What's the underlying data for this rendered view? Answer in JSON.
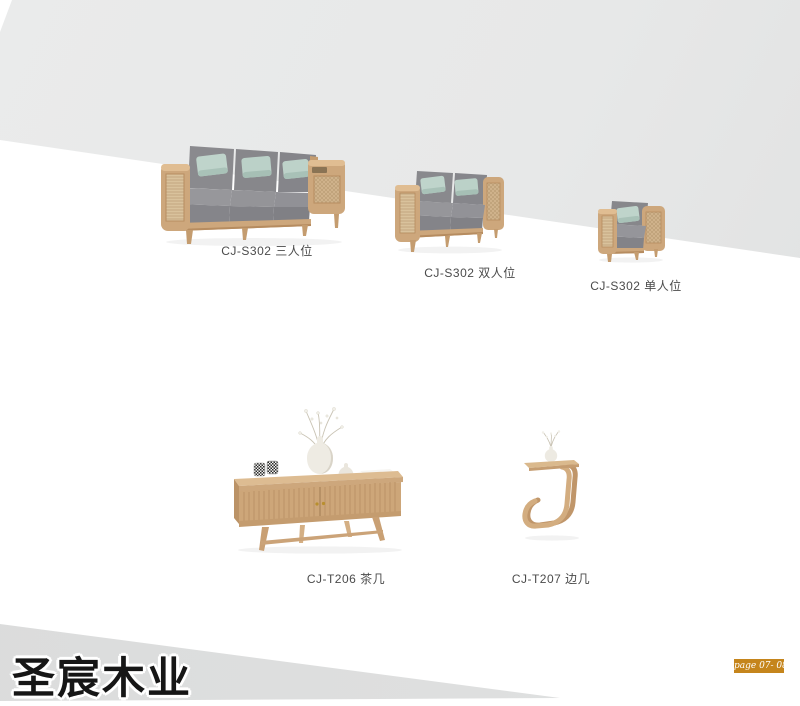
{
  "brand": {
    "name": "圣宸木业"
  },
  "page_badge": {
    "text": "page 07- 08",
    "bg_color": "#c5851c"
  },
  "products": [
    {
      "label": "CJ-S302 三人位",
      "kind": "three-seat-sofa"
    },
    {
      "label": "CJ-S302 双人位",
      "kind": "two-seat-sofa"
    },
    {
      "label": "CJ-S302 单人位",
      "kind": "single-seat-armchair"
    },
    {
      "label": "CJ-T206 茶几",
      "kind": "coffee-table"
    },
    {
      "label": "CJ-T207 边几",
      "kind": "side-table"
    }
  ],
  "colors": {
    "wall": "#e7e8e8",
    "floor_wedge": "#dcdddd",
    "wood": "#cda77c",
    "wood_dark": "#b68c60",
    "rattan": "#d8c09b",
    "cushion_gray": "#8d8d90",
    "pillow_mint": "#bfd3ca",
    "label_text": "#4b4b4b",
    "badge_orange": "#c5851c"
  }
}
